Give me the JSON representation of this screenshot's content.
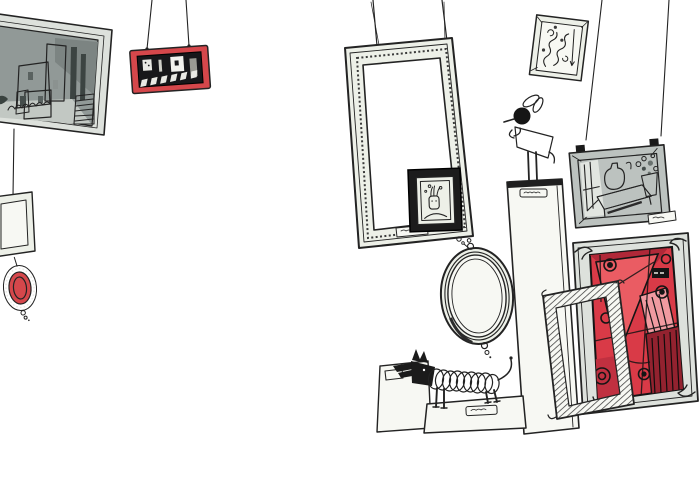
{
  "app": {
    "title": "Hand-drawn gallery wall illustration",
    "style": "pen-and-ink sketch with gray watercolor washes and red accents",
    "readable_text": "none (all plaques are illegible scribbles)"
  },
  "palette": {
    "paper": "#ffffff",
    "ink": "#232323",
    "ink_soft": "#555d5b",
    "frame_fill": "#edf0e8",
    "frame_bright": "#f7f8f3",
    "wash_dark": "#919997",
    "wash_mid": "#bcc2bf",
    "wash_light": "#dde1dc",
    "black_frame": "#1c1c1c",
    "red_frame": "#d5474b",
    "red_main": "#d93a47",
    "red_bright": "#ea5c63",
    "red_pink": "#f09aa0",
    "red_deep": "#93222f",
    "red_dark": "#b02838"
  },
  "scene": {
    "background": "#ffffff",
    "items": {
      "landscape": {
        "label": "framed grayscale village landscape painting, top left, cut off at edge"
      },
      "string_left": {
        "label": "hanging wire below landscape painting"
      },
      "small_frame": {
        "label": "small empty square frame hanging at left edge"
      },
      "oval_red": {
        "label": "small ornate oval frame with red ring and bead dangle"
      },
      "red_city": {
        "label": "small red-framed dark street scene hanging from two wires"
      },
      "big_frame": {
        "label": "large empty ornate frame hanging from two wires, center"
      },
      "portrait": {
        "label": "small black-framed doodle portrait overlapping big frame corner"
      },
      "swirl_frame": {
        "label": "small tilted frame with swirl ornament doodles, top right"
      },
      "still_life": {
        "label": "gray-framed still life with table, jug and flowers, hung from two long wires with clips"
      },
      "pedestal": {
        "label": "tall white pedestal column with scribbled label"
      },
      "bird": {
        "label": "black bird sculpture with hatched body standing on pedestal"
      },
      "mirror": {
        "label": "oval mirror with concentric rings and bead dangles"
      },
      "red_abstract": {
        "label": "large red cubist abstract painting in gray frame with corner curls"
      },
      "hatched_frame": {
        "label": "empty tilted frame with hatched border leaning in front"
      },
      "dog": {
        "label": "dachshund sketch with coiled spring body on plinth"
      },
      "card": {
        "label": "tilted blank card leaning at floor"
      },
      "platform": {
        "label": "low plinth with label slot under the dog"
      },
      "labels": {
        "label": "illegible scribbled title plaques"
      }
    }
  }
}
